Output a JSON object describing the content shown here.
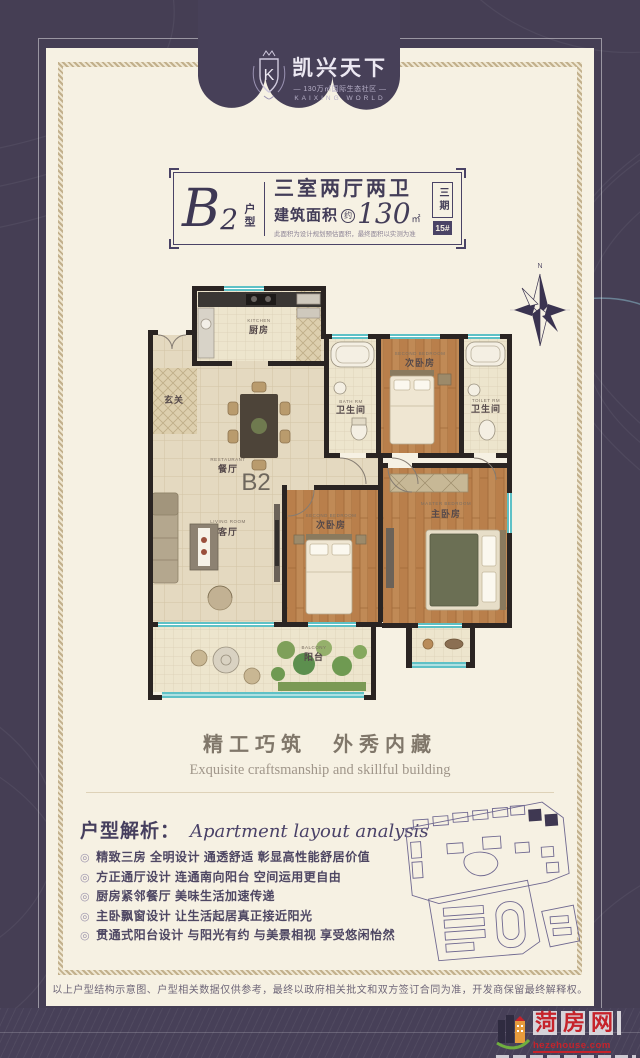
{
  "brand": {
    "monogram": "K",
    "name": "凯兴天下",
    "subtitle": "— 130万㎡国际生态社区 —",
    "name_en": "KAIXING WORLD"
  },
  "title_box": {
    "unit_letter": "B",
    "unit_number": "2",
    "unit_suffix": "户型",
    "rooms_headline": "三室两厅两卫",
    "area_label": "建筑面积",
    "area_approx": "约",
    "area_value": "130",
    "area_unit": "㎡",
    "area_note": "此面积为设计规划预估面积，最终面积以实测为准",
    "phase": "三期",
    "building_no": "15#"
  },
  "floor_plan": {
    "plan_label": "B2",
    "compass_label": "N",
    "rooms": {
      "kitchen": {
        "zh": "厨房",
        "en": "KITCHEN"
      },
      "foyer": {
        "zh": "玄关"
      },
      "dining": {
        "zh": "餐厅",
        "en": "RESTAURANT"
      },
      "bath1": {
        "zh": "卫生间",
        "en": "BATH RM"
      },
      "bedroom2": {
        "zh": "次卧房",
        "en": "SECOND BEDROOM"
      },
      "bath2": {
        "zh": "卫生间",
        "en": "TOILET RM"
      },
      "living": {
        "zh": "客厅",
        "en": "LIVING ROOM"
      },
      "bedroom3": {
        "zh": "次卧房",
        "en": "SECOND BEDROOM"
      },
      "master": {
        "zh": "主卧房",
        "en": "MASTER BEDROOM"
      },
      "balcony": {
        "zh": "阳台",
        "en": "BALCONY"
      }
    }
  },
  "slogan": {
    "zh": "精工巧筑　外秀内藏",
    "en": "Exquisite craftsmanship and skillful building"
  },
  "analysis": {
    "title_zh": "户型解析：",
    "title_en": "Apartment layout analysis",
    "bullet_icon": "◎",
    "bullets": [
      "精致三房 全明设计 通透舒适 彰显高性能舒居价值",
      "方正通厅设计 连通南向阳台 空间运用更自由",
      "厨房紧邻餐厅 美味生活加速传递",
      "主卧飘窗设计 让生活起居真正接近阳光",
      "贯通式阳台设计 与阳光有约 与美景相视 享受悠闲怡然"
    ]
  },
  "disclaimer": "以上户型结构示意图、户型相关数据仅供参考，最终以政府相关批文和双方签订合同为准，开发商保留最终解释权。",
  "footer": {
    "site_name": "菏房网",
    "site_url": "hezehouse.com",
    "tagline": "菏泽房产门户网站"
  },
  "colors": {
    "frame": "#453e54",
    "page": "#f6f1e3",
    "accent_red": "#c6232b",
    "wall": "#2a2422",
    "window_teal": "#5ec1c6"
  }
}
